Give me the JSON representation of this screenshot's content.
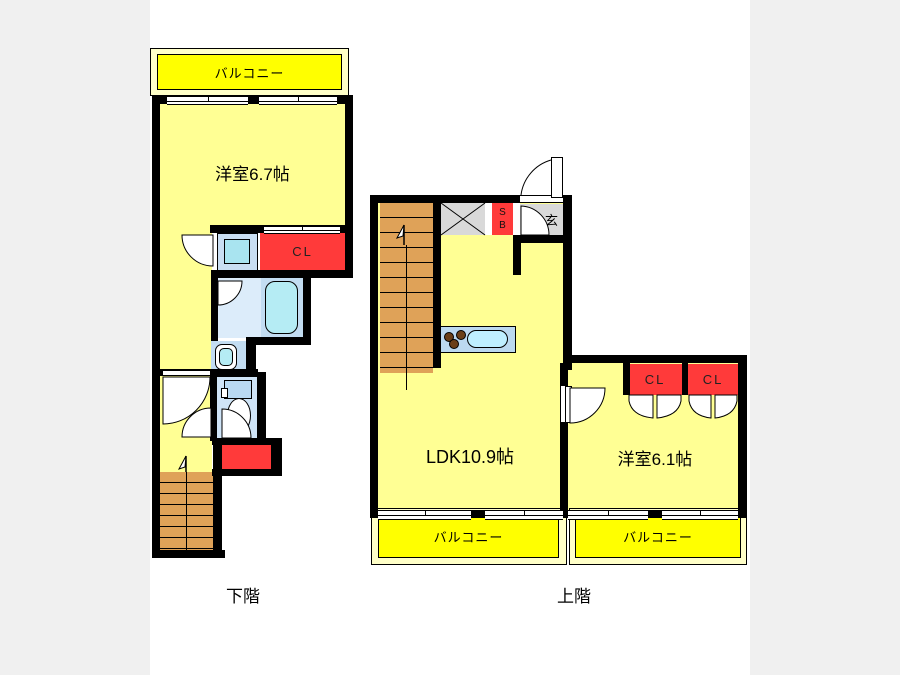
{
  "lower_floor": {
    "floor_label": "下階",
    "balcony_label": "バルコニー",
    "room_label": "洋室6.7帖",
    "closet_label": "CL"
  },
  "upper_floor": {
    "floor_label": "上階",
    "entrance_label": "玄",
    "shoe_box": {
      "line1": "S",
      "line2": "B"
    },
    "ldk_label": "LDK10.9帖",
    "room_label": "洋室6.1帖",
    "closet1_label": "CL",
    "closet2_label": "CL",
    "balcony1_label": "バルコニー",
    "balcony2_label": "バルコニー"
  },
  "colors": {
    "wall": "#000000",
    "room_fill": "#ffff94",
    "balcony_fill": "#ffff00",
    "balcony_margin": "#ffffc8",
    "closet_red": "#ff3a3a",
    "stairs_tan": "#dfa258",
    "service_gray": "#d9d9d9",
    "bath_blue": "#c3ddf2",
    "bath_light": "#dcecfa",
    "toilet_blue": "#cfe4f7",
    "fixture_cyan": "#b5ecf4",
    "counter_blue": "#bcd9f0",
    "background_gray": "#f0f0f0"
  }
}
